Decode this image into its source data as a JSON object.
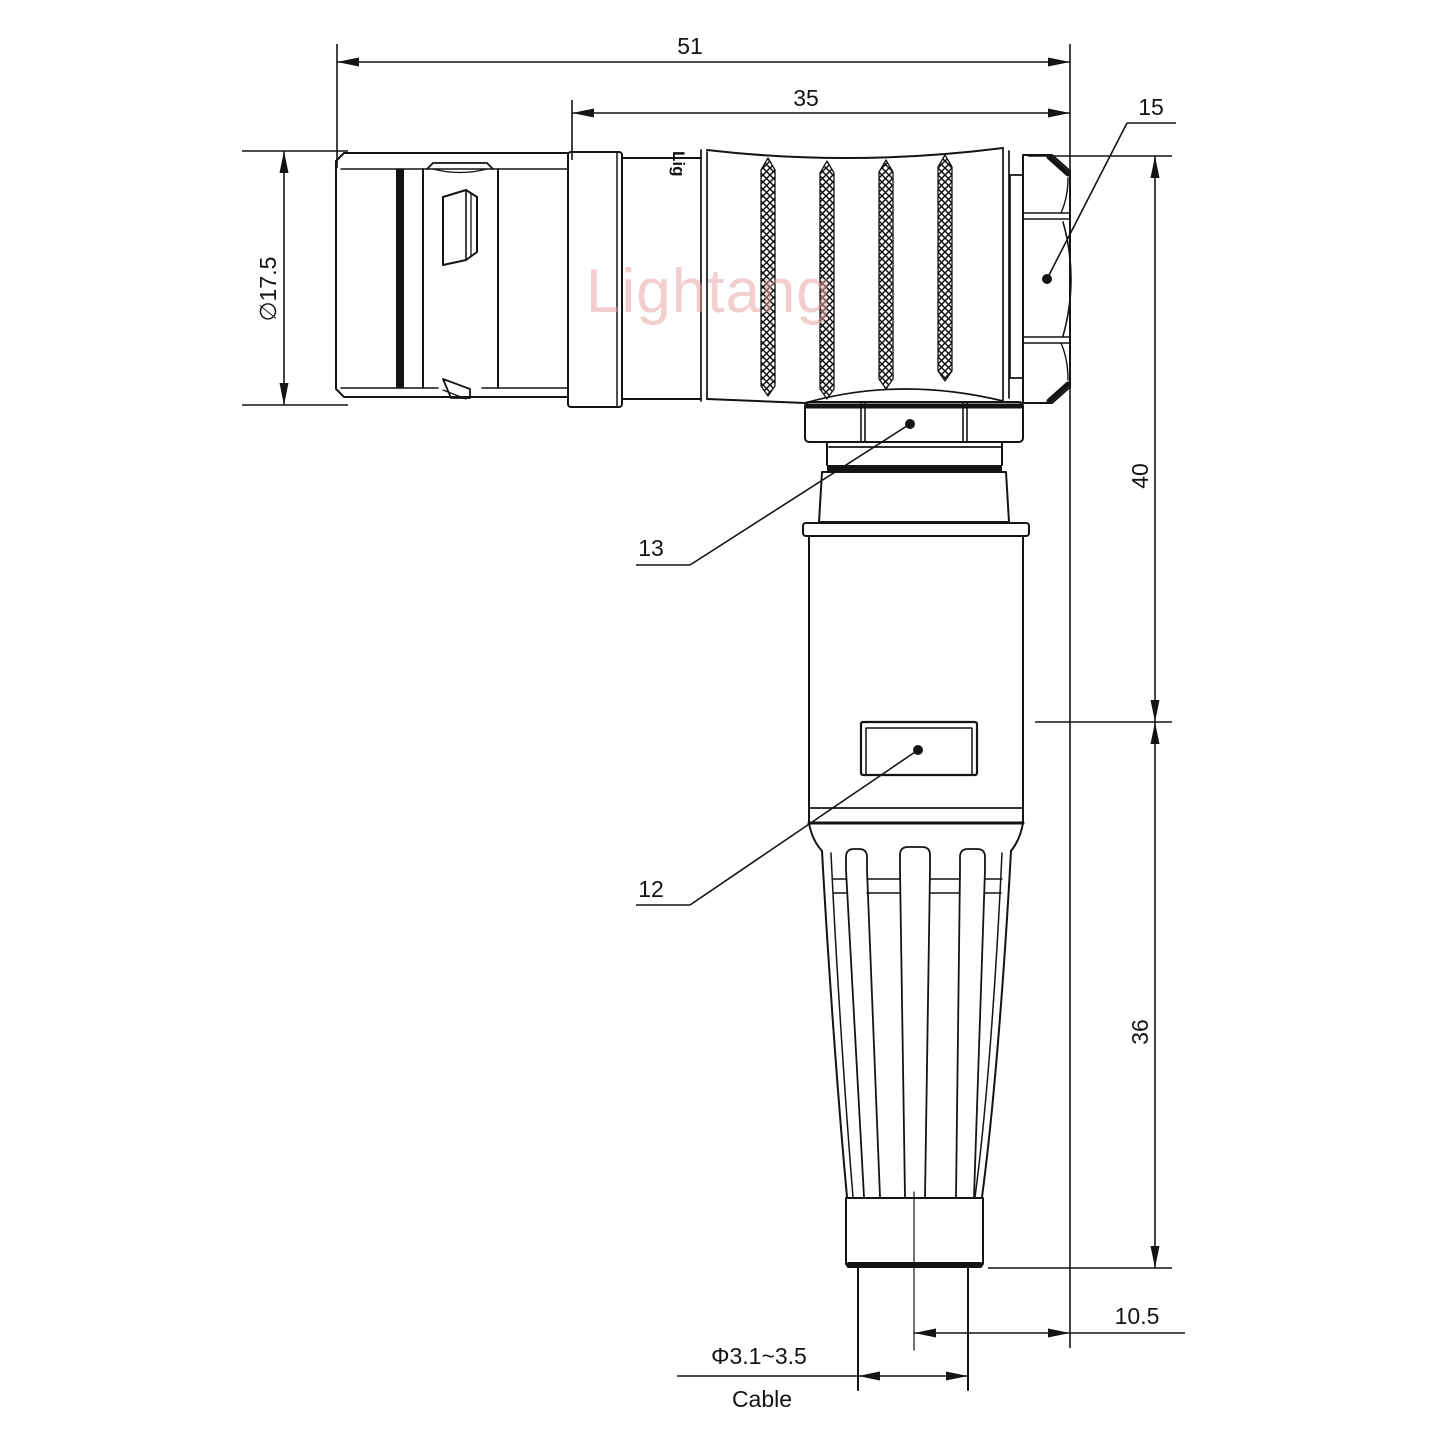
{
  "watermark": {
    "text": "Lightang"
  },
  "brand_mark": {
    "text": "Lig"
  },
  "dimensions": {
    "overall_length": {
      "value": "51"
    },
    "rear_length": {
      "value": "35"
    },
    "front_diameter": {
      "value": "∅17.5"
    },
    "upper_height": {
      "value": "40"
    },
    "lower_height": {
      "value": "36"
    },
    "cable_offset": {
      "value": "10.5"
    },
    "cable_diameter": {
      "value": "Φ3.1~3.5"
    },
    "cable_label": {
      "value": "Cable"
    }
  },
  "callouts": {
    "hex_nut": {
      "number": "15"
    },
    "coupling_nut": {
      "number": "13"
    },
    "cable_clamp": {
      "number": "12"
    }
  }
}
